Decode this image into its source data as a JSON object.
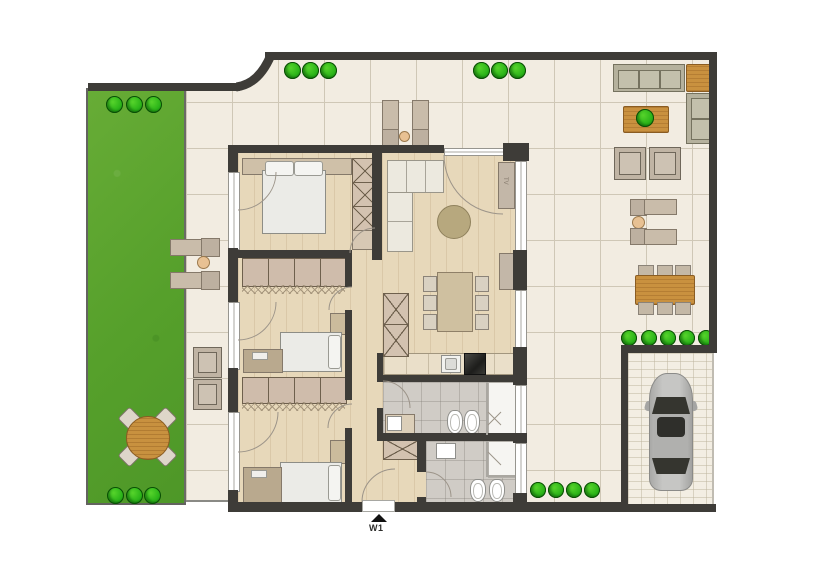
{
  "plan": {
    "entrance_label": "W1",
    "tv_label": "TV"
  },
  "colors": {
    "wall": "#3e3c38",
    "lawn": "#5fa630",
    "bush": "#2db61a",
    "terrace": "#f2ece1",
    "tileline": "#cfc7b6",
    "wood": "#e7d8ba",
    "bath": "#d0ccc6",
    "outwood": "#c9913f",
    "inwood": "#cfc0a0",
    "sofa": "#b5b19d",
    "tan": "#c9bcaa",
    "mattress": "#ebebe7",
    "car": "#b7b7b5",
    "paver": "#f3eee3"
  }
}
